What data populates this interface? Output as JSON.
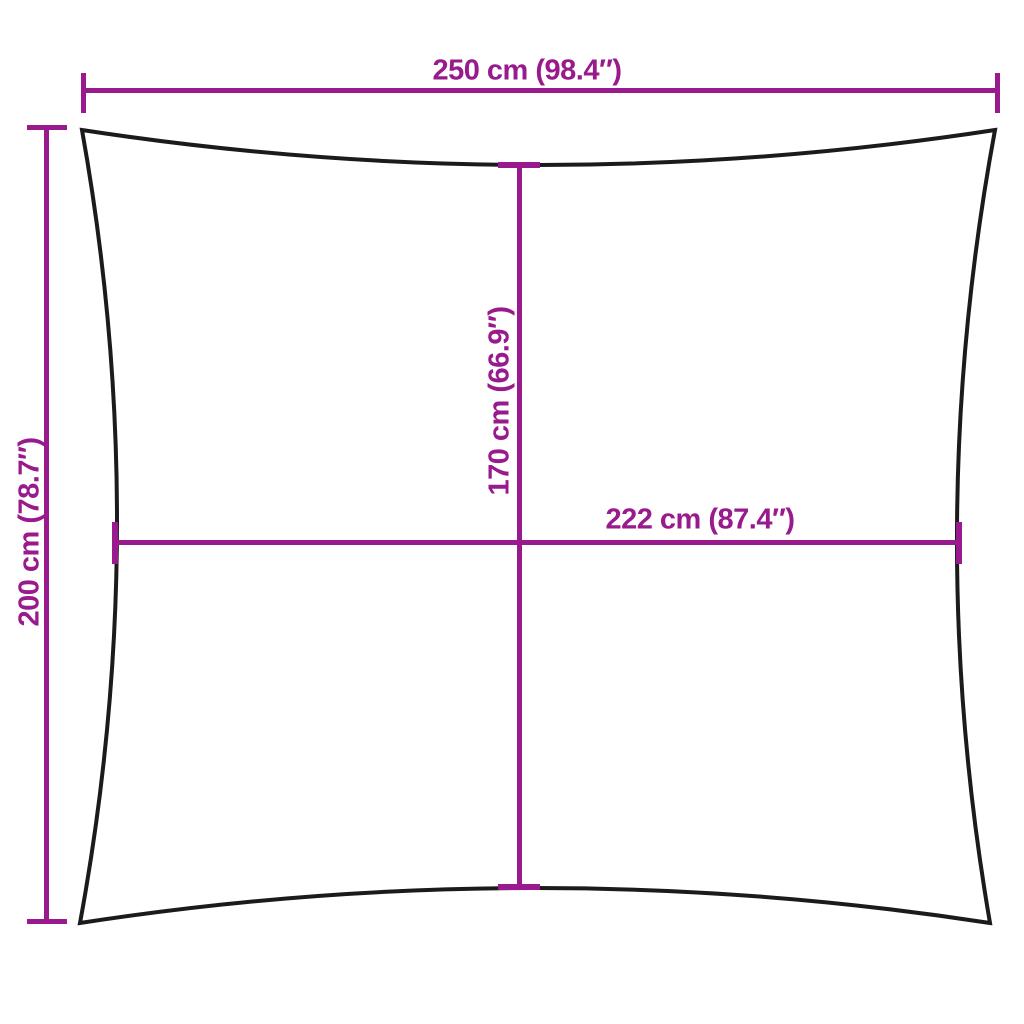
{
  "colors": {
    "background": "#ffffff",
    "sail_outline": "#1b1b1b",
    "dimension": "#981a8d"
  },
  "diagram": {
    "labels": {
      "top_width": "250 cm (98.4″)",
      "left_height": "200 cm (78.7″)",
      "inner_height": "170 cm (66.9″)",
      "inner_width": "222 cm (87.4″)"
    }
  }
}
